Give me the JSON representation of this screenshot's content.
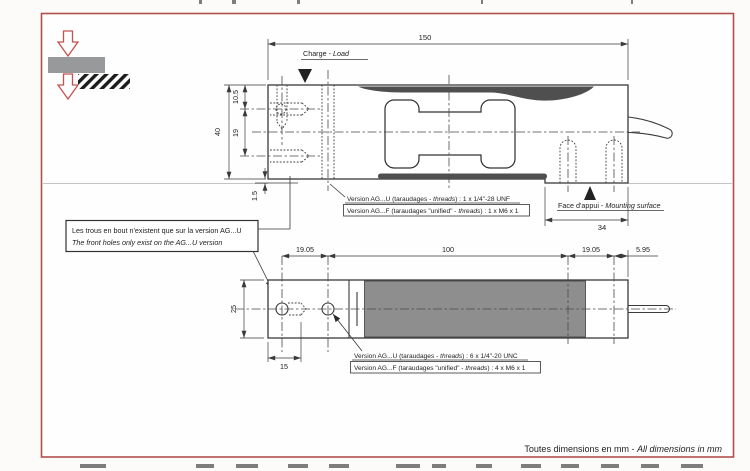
{
  "colors": {
    "page_border": "#b0504c",
    "dark_band": "#4f4f4f",
    "boot_gray": "#8e8e8e",
    "beam_gray": "#97999b",
    "load_arrow_red": "#c4534f"
  },
  "top_view": {
    "charge_label": {
      "fr": "Charge - ",
      "en": "Load"
    },
    "dim_length": "150",
    "dim_height": "40",
    "dim_hole_top": "10.5",
    "dim_hole_pitch": "19",
    "dim_recess": "1.5",
    "dim_mounting": "34",
    "version_u": {
      "pre": "Version AG...U (taraudages - ",
      "it": "threads",
      "post": ") : 1 x 1/4\"-28 UNF"
    },
    "version_f": {
      "pre": "Version AG...F (taraudages \"unified\" - ",
      "it": "threads",
      "post": ") : 1 x M6 x 1"
    },
    "mounting_label": {
      "fr": "Face d'appui - ",
      "en": "Mounting surface"
    }
  },
  "callout": {
    "fr": "Les trous en bout n'existent que sur la version AG...U",
    "en": "The front holes only exist on the AG...U version"
  },
  "side_view": {
    "dim_pitch_left": "19.05",
    "dim_center": "100",
    "dim_pitch_right": "19.05",
    "dim_cable": "5.95",
    "dim_height": "25",
    "dim_depth": "15",
    "version_u": {
      "pre": "Version AG...U (taraudages - ",
      "it": "threads",
      "post": ") : 6 x 1/4\"-20 UNC"
    },
    "version_f": {
      "pre": "Version AG...F (taraudages \"unified\" - ",
      "it": "threads",
      "post": ") : 4 x M6 x 1"
    }
  },
  "footer": {
    "fr": "Toutes dimensions en mm",
    "sep": " - ",
    "en": "All dimensions in mm"
  }
}
